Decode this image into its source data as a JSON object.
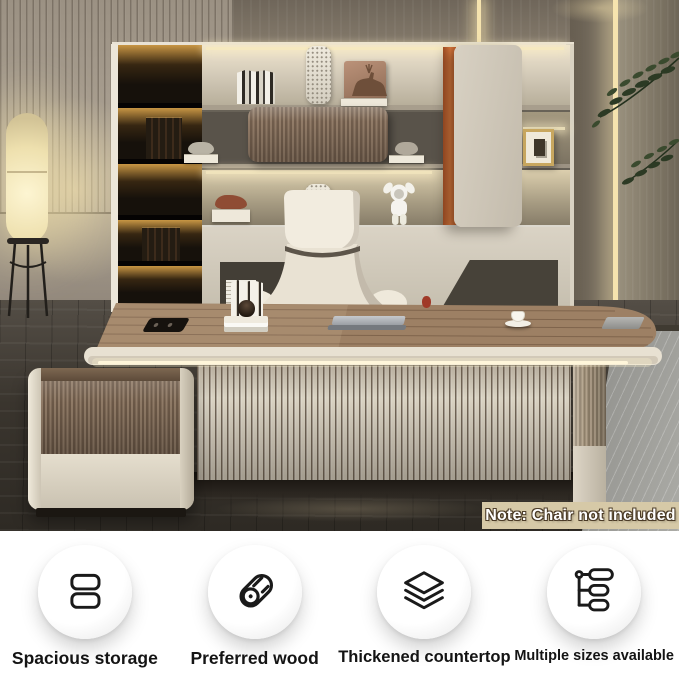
{
  "photo": {
    "note_badge": {
      "text": "Note: Chair not included"
    }
  },
  "features": [
    {
      "icon": "storage-drawers-icon",
      "label": "Spacious storage"
    },
    {
      "icon": "wood-log-icon",
      "label": "Preferred wood"
    },
    {
      "icon": "stacked-layers-icon",
      "label": "Thickened countertop"
    },
    {
      "icon": "size-options-icon",
      "label": "Multiple sizes available"
    }
  ],
  "colors": {
    "accent_orange": "#dd7a3e",
    "desk_wood": "#9d8064",
    "cream_panel": "#e8e1d2",
    "wall_taupe": "#a79d8e",
    "wall_dark": "#7a7062",
    "led_glow": "#f5e3ae",
    "floor_dark": "#3b3731",
    "floor_light": "#a2a29e",
    "chair_cream": "#eee8da",
    "plant_green": "#2c3a24",
    "note_bg": "#d6c9a7",
    "note_text": "#ffffff",
    "note_outline": "#4a3a26",
    "icon_stroke": "#1a1a1a"
  }
}
